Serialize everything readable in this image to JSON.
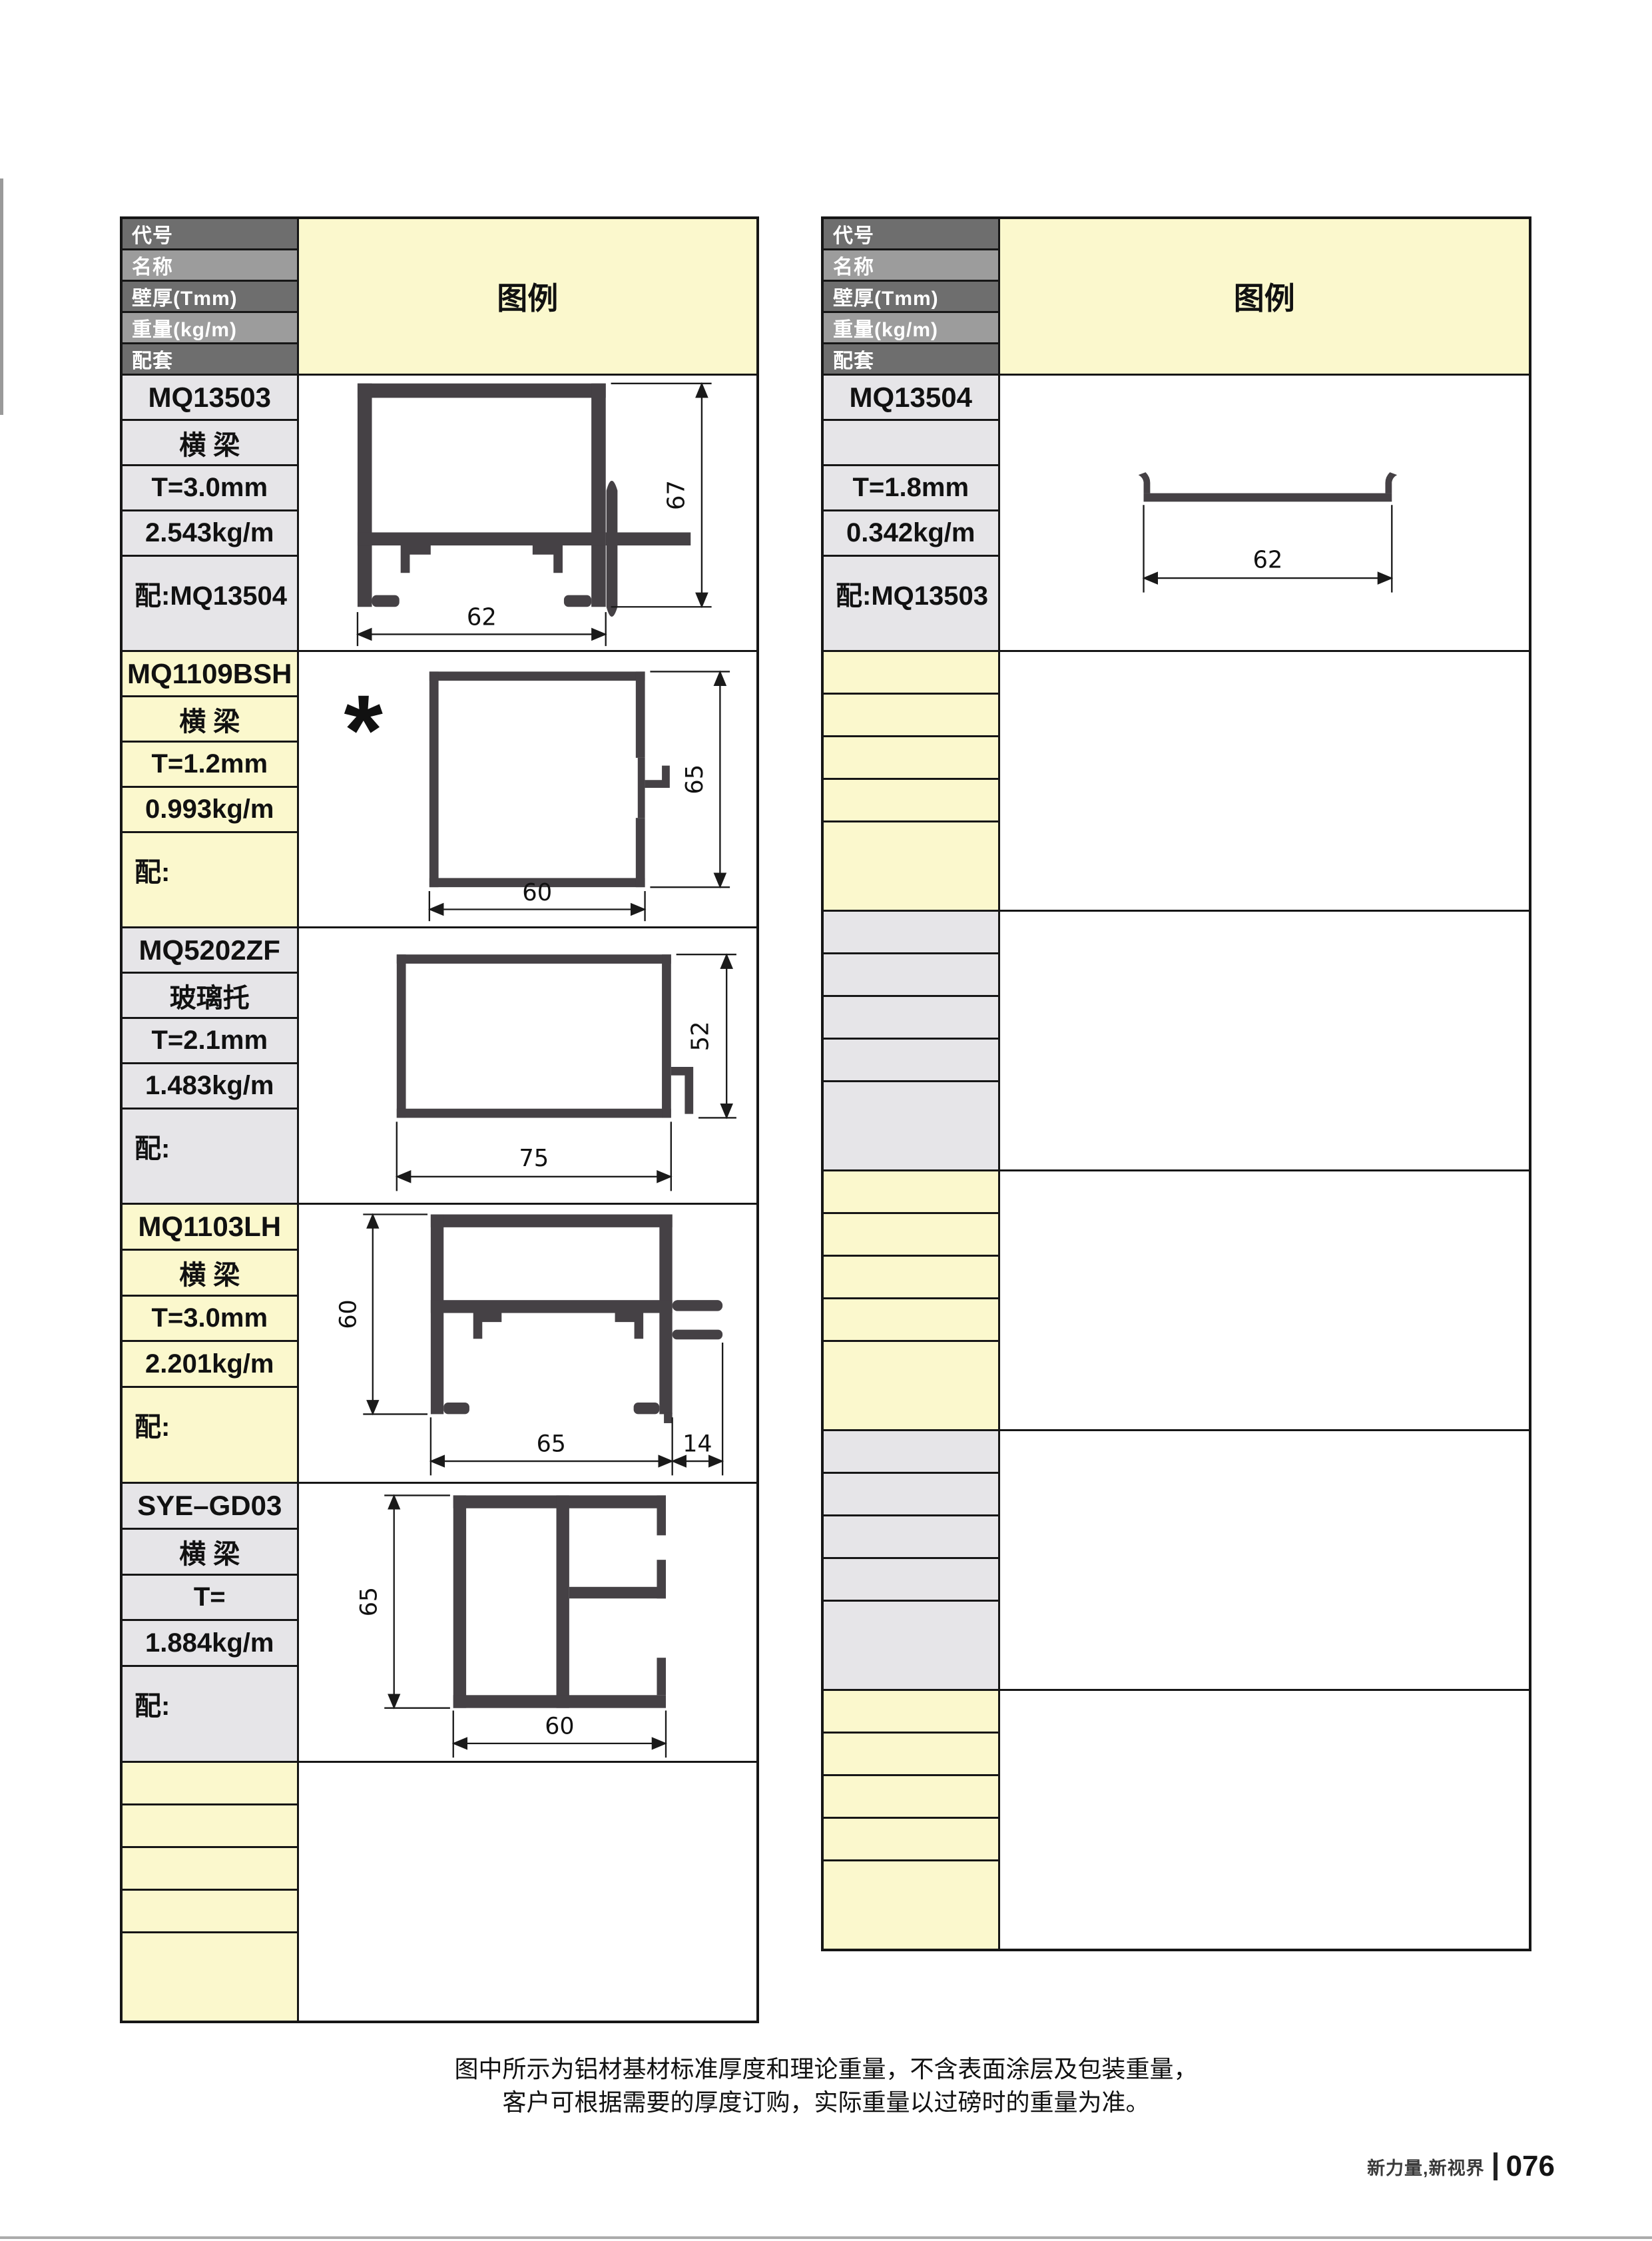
{
  "header": {
    "row_labels": [
      "代号",
      "名称",
      "壁厚(Tmm)",
      "重量(kg/m)",
      "配套"
    ],
    "legend_label": "图例"
  },
  "left_table": {
    "rows": [
      {
        "code": "MQ13503",
        "name": "横 梁",
        "thickness": "T=3.0mm",
        "weight": "2.543kg/m",
        "match": "配:MQ13504",
        "dim_width": "62",
        "dim_height": "67"
      },
      {
        "code": "MQ1109BSH",
        "name": "横 梁",
        "thickness": "T=1.2mm",
        "weight": "0.993kg/m",
        "match": "配:",
        "marker": "*",
        "dim_width": "60",
        "dim_height": "65"
      },
      {
        "code": "MQ5202ZF",
        "name": "玻璃托",
        "thickness": "T=2.1mm",
        "weight": "1.483kg/m",
        "match": "配:",
        "dim_width": "75",
        "dim_height": "52"
      },
      {
        "code": "MQ1103LH",
        "name": "横 梁",
        "thickness": "T=3.0mm",
        "weight": "2.201kg/m",
        "match": "配:",
        "dim_width": "65",
        "dim_width2": "14",
        "dim_height": "60"
      },
      {
        "code": "SYE–GD03",
        "name": "横 梁",
        "thickness": "T=",
        "weight": "1.884kg/m",
        "match": "配:",
        "dim_width": "60",
        "dim_height": "65"
      },
      {
        "code": "",
        "name": "",
        "thickness": "",
        "weight": "",
        "match": ""
      }
    ]
  },
  "right_table": {
    "rows": [
      {
        "code": "MQ13504",
        "name": "",
        "thickness": "T=1.8mm",
        "weight": "0.342kg/m",
        "match": "配:MQ13503",
        "dim_width": "62"
      },
      {
        "code": "",
        "name": "",
        "thickness": "",
        "weight": "",
        "match": ""
      },
      {
        "code": "",
        "name": "",
        "thickness": "",
        "weight": "",
        "match": ""
      },
      {
        "code": "",
        "name": "",
        "thickness": "",
        "weight": "",
        "match": ""
      },
      {
        "code": "",
        "name": "",
        "thickness": "",
        "weight": "",
        "match": ""
      },
      {
        "code": "",
        "name": "",
        "thickness": "",
        "weight": "",
        "match": ""
      }
    ]
  },
  "footer": {
    "note_line1": "图中所示为铝材基材标准厚度和理论重量，不含表面涂层及包装重量，",
    "note_line2": "客户可根据需要的厚度订购，实际重量以过磅时的重量为准。",
    "brand": "新力量,新视界",
    "page_number": "076"
  },
  "colors": {
    "accent_yellow": "#FBF8CD",
    "cell_gray": "#E6E5E8",
    "header_dark": "#6E6E6E",
    "header_light": "#9C9C9C",
    "profile_fill": "#454145",
    "border": "#161616"
  }
}
